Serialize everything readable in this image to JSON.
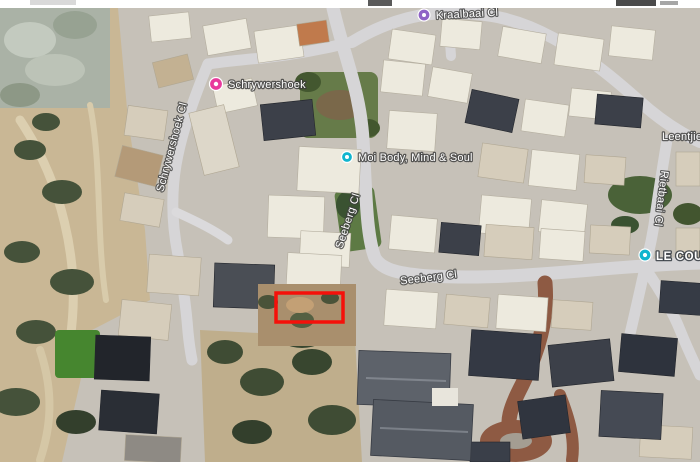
{
  "map": {
    "kind": "satellite-imagery",
    "labels": {
      "kraalbaai_road": "Kraalbaai Cl",
      "schrywershoek_poi": "Schrywershoek",
      "moi_body_poi": "Moi Body, Mind & Soul",
      "schrywershoek_road": "Schrywershoek Cl",
      "seeberg_road_upper": "Seeberg Cl",
      "seeberg_road_lower": "Seeberg Cl",
      "leentjiesklip_road": "Leentjie",
      "rietbaai_road": "Rietbaai Cl",
      "le_courier_poi": "LE COURI"
    },
    "pins": {
      "kraalbaai": {
        "color": "#8f63c6"
      },
      "schrywershoek": {
        "color": "#e83a9c"
      },
      "moi_body": {
        "color": "#10b5ce"
      },
      "le_courier": {
        "color": "#10b5ce"
      }
    },
    "highlight": {
      "color": "#f5100a"
    }
  }
}
